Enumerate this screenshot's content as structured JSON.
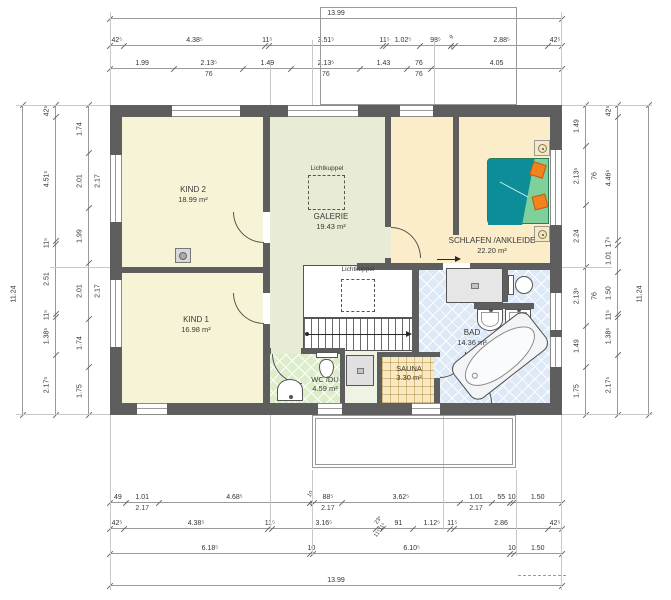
{
  "skylight": {
    "label": "Lichtkuppel"
  },
  "rooms": {
    "kind2": {
      "label": "KIND 2",
      "area": "18.99 m²"
    },
    "kind1": {
      "label": "KIND 1",
      "area": "16.98 m²"
    },
    "galerie": {
      "label": "GALERIE",
      "area": "19.43 m²"
    },
    "schlafen": {
      "label": "SCHLAFEN /ANKLEIDE",
      "area": "22.20 m²"
    },
    "bad": {
      "label": "BAD",
      "area": "14.36 m²"
    },
    "wc": {
      "label": "WC /DU",
      "area": "4.59 m²"
    },
    "sauna": {
      "label": "SAUNA",
      "area": "3.30 m²"
    }
  },
  "colors": {
    "wall": "#5e5e5e",
    "kids": "#f7f3d6",
    "galerie": "#e8ebd5",
    "bedroom": "#fbecca",
    "bath_tile": "#dde9f6",
    "wc_tile": "#ddedc9",
    "corridor": "#eef3e3",
    "sauna": "#f8e9c0",
    "bed": "#0d8d97",
    "blanket": "#7fd09b",
    "pillow": "#f3821f"
  },
  "dims": {
    "top": {
      "rows": [
        [
          {
            "v": "13.99",
            "span": 13.99
          }
        ],
        [
          {
            "v": "42⁵",
            "span": 0.425
          },
          {
            "v": "4.38⁵",
            "span": 4.385
          },
          {
            "v": "11⁵",
            "span": 0.115
          },
          {
            "v": "3.51⁵",
            "span": 3.515
          },
          {
            "v": "11⁵",
            "span": 0.115
          },
          {
            "v": "1.02⁵",
            "span": 1.025
          },
          {
            "v": "98⁵",
            "span": 0.985
          },
          {
            "v": "9",
            "sub": "2⁵",
            "span": 0.115,
            "rot": true
          },
          {
            "v": "2.88⁵",
            "span": 2.885
          },
          {
            "v": "42⁵",
            "span": 0.425
          }
        ],
        [
          {
            "v": "1.99",
            "span": 1.99
          },
          {
            "v": "2.13⁵",
            "sub": "76",
            "span": 2.135
          },
          {
            "v": "1.49",
            "span": 1.49
          },
          {
            "v": "2.13⁵",
            "sub": "76",
            "span": 2.135
          },
          {
            "v": "1.43",
            "span": 1.43
          },
          {
            "v": "76",
            "sub": "76",
            "span": 0.76
          },
          {
            "v": "4.05",
            "span": 4.05
          }
        ]
      ]
    },
    "bottom": {
      "rows": [
        [
          {
            "v": "49",
            "span": 0.49
          },
          {
            "v": "1.01",
            "sub": "2.17",
            "span": 1.01
          },
          {
            "v": "4.68⁵",
            "span": 4.685
          },
          {
            "v": "10",
            "sub": "3²",
            "span": 0.1,
            "rot": true
          },
          {
            "v": "88⁵",
            "sub": "2.17",
            "span": 0.885
          },
          {
            "v": "3.62⁵",
            "span": 3.625
          },
          {
            "v": "1.01",
            "sub": "2.17",
            "span": 1.01
          },
          {
            "v": "55",
            "span": 0.55
          },
          {
            "v": "10",
            "span": 0.1
          },
          {
            "v": "1.50",
            "span": 1.5
          }
        ],
        [
          {
            "v": "42⁵",
            "span": 0.425
          },
          {
            "v": "4.38⁵",
            "span": 4.385
          },
          {
            "v": "11⁵",
            "span": 0.115
          },
          {
            "v": "3.16⁵",
            "span": 3.165
          },
          {
            "v": "23⁵",
            "sub": "11⁵11⁵",
            "span": 0.235,
            "rot": true
          },
          {
            "v": "91",
            "span": 0.91
          },
          {
            "v": "1.12⁵",
            "span": 1.125
          },
          {
            "v": "11⁵",
            "span": 0.115
          },
          {
            "v": "2.86",
            "span": 2.86
          },
          {
            "v": "42⁵",
            "span": 0.425
          }
        ],
        [
          {
            "v": "6.18⁵",
            "span": 6.185
          },
          {
            "v": "10",
            "span": 0.1
          },
          {
            "v": "6.10⁵",
            "span": 6.105
          },
          {
            "v": "10",
            "span": 0.1
          },
          {
            "v": "1.50",
            "span": 1.5
          }
        ],
        [
          {
            "v": "13.99",
            "span": 13.99
          }
        ]
      ]
    },
    "left": {
      "rows": [
        [
          {
            "v": "11.24",
            "span": 11.24,
            "at": 61
          }
        ],
        [
          {
            "v": "42⁵",
            "span": 0.425
          },
          {
            "v": "4.51⁵",
            "span": 4.515
          },
          {
            "v": "11⁵",
            "span": 0.115
          },
          {
            "v": "2.51",
            "span": 2.51
          },
          {
            "v": "11⁵",
            "span": 0.115
          },
          {
            "v": "1.38⁵",
            "span": 1.385
          },
          {
            "v": "2.17⁵",
            "span": 2.175
          }
        ],
        [
          {
            "v": "1.74",
            "span": 1.74
          },
          {
            "v": "2.01",
            "sub": "2.17",
            "span": 2.01
          },
          {
            "v": "1.99",
            "span": 1.99
          },
          {
            "v": "2.01",
            "sub": "2.17",
            "span": 2.01
          },
          {
            "v": "1.74",
            "span": 1.74
          },
          {
            "v": "1.75",
            "span": 1.75
          }
        ]
      ]
    },
    "right": {
      "rows": [
        [
          {
            "v": "1.49",
            "span": 1.49
          },
          {
            "v": "2.13⁵",
            "sub": "76",
            "span": 2.135
          },
          {
            "v": "2.24",
            "span": 2.24
          },
          {
            "v": "2.13⁵",
            "sub": "76",
            "span": 2.135
          },
          {
            "v": "1.49",
            "span": 1.49
          },
          {
            "v": "1.75",
            "span": 1.75
          }
        ],
        [
          {
            "v": "42⁵",
            "span": 0.425
          },
          {
            "v": "4.46⁵",
            "span": 4.465
          },
          {
            "v": "17⁵",
            "span": 0.175
          },
          {
            "v": "1.01",
            "span": 1.01
          },
          {
            "v": "1.50",
            "span": 1.5
          },
          {
            "v": "11⁵",
            "span": 0.115
          },
          {
            "v": "1.38⁵",
            "span": 1.385
          },
          {
            "v": "2.17⁵",
            "span": 2.175
          }
        ],
        [
          {
            "v": "11.24",
            "span": 11.24,
            "at": 61
          }
        ]
      ]
    }
  }
}
